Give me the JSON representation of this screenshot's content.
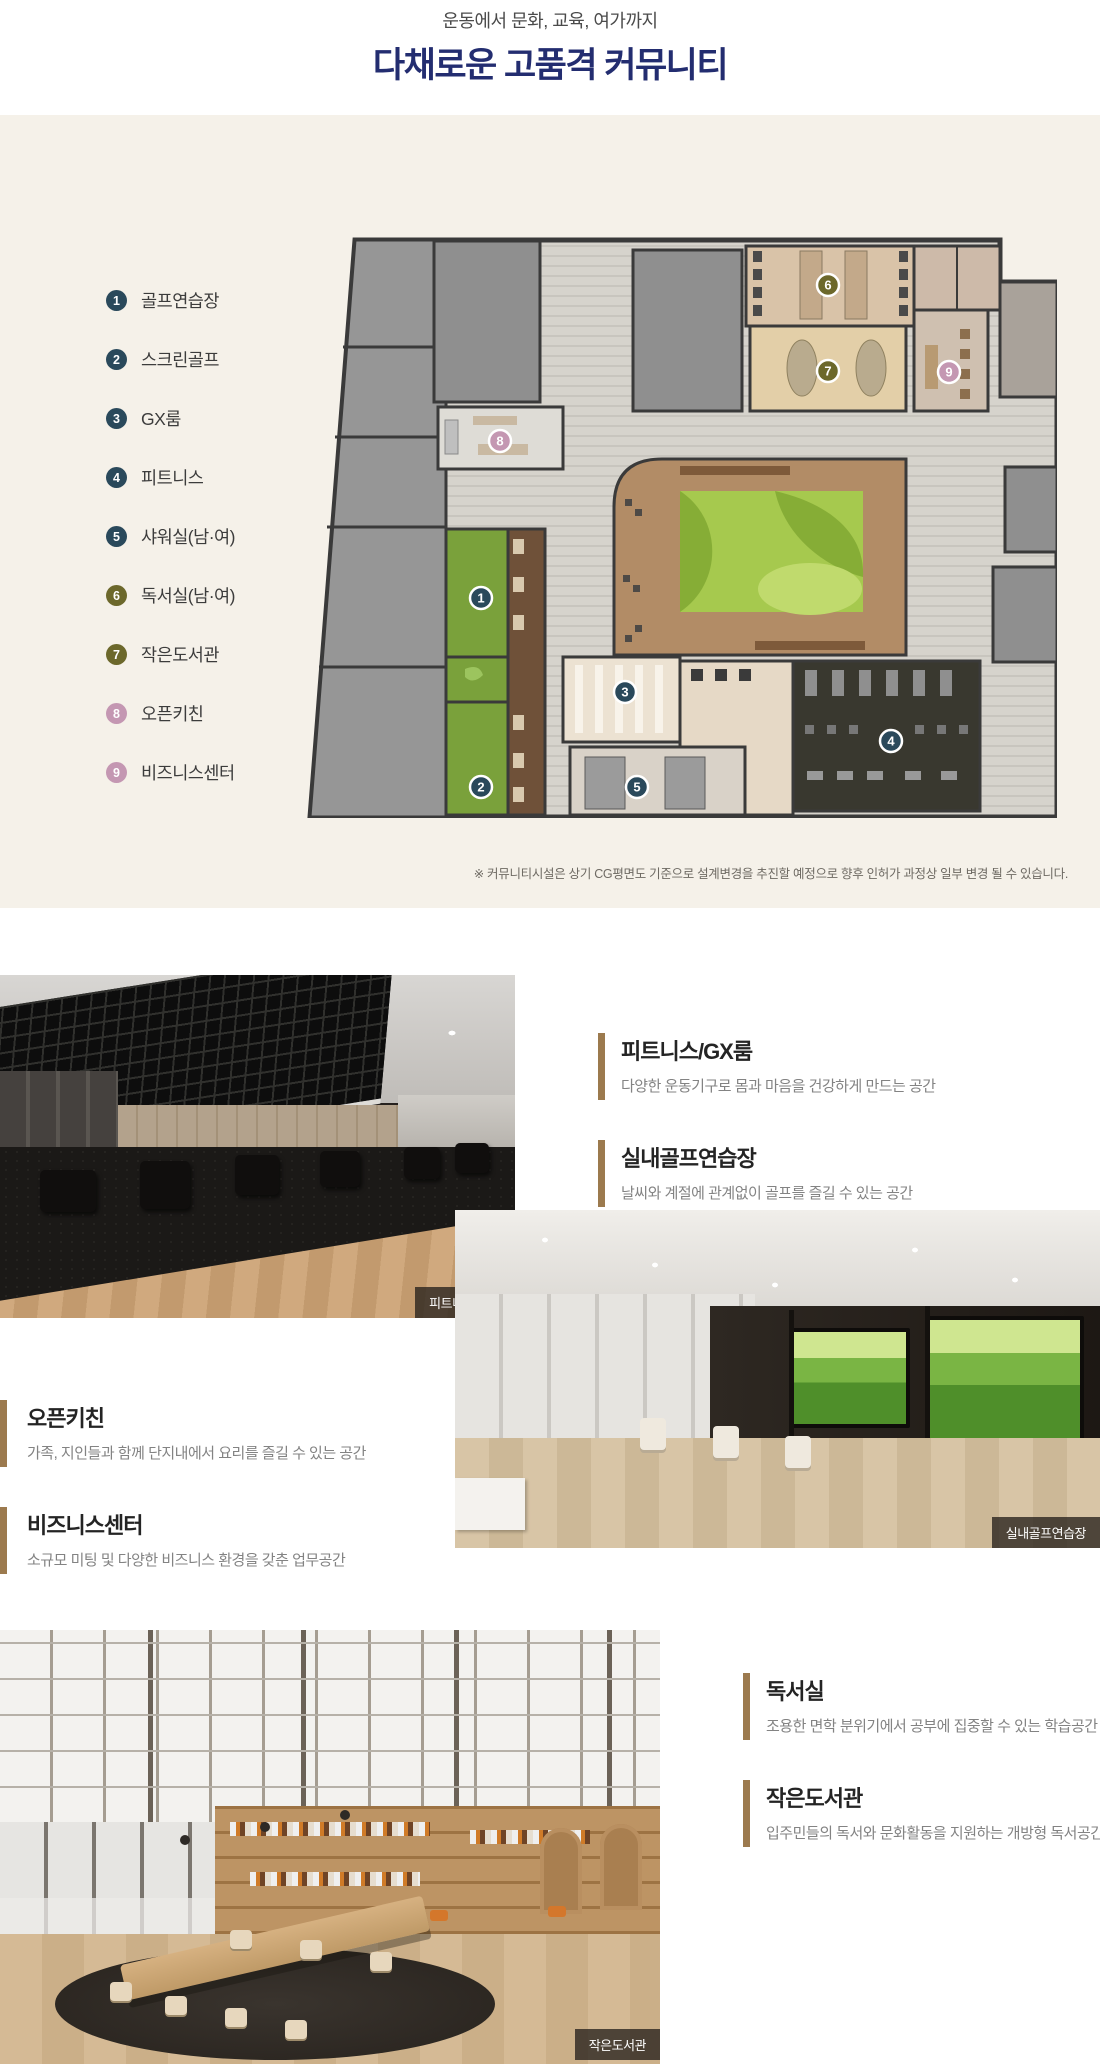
{
  "header": {
    "subtitle": "운동에서 문화, 교육, 여가까지",
    "title": "다채로운 고품격 커뮤니티"
  },
  "plan": {
    "legend": [
      {
        "num": "1",
        "label": "골프연습장",
        "color": "#2a495b"
      },
      {
        "num": "2",
        "label": "스크린골프",
        "color": "#2a495b"
      },
      {
        "num": "3",
        "label": "GX룸",
        "color": "#2a495b"
      },
      {
        "num": "4",
        "label": "피트니스",
        "color": "#2a495b"
      },
      {
        "num": "5",
        "label": "샤워실(남·여)",
        "color": "#2a495b"
      },
      {
        "num": "6",
        "label": "독서실(남·여)",
        "color": "#6c682b"
      },
      {
        "num": "7",
        "label": "작은도서관",
        "color": "#6c682b"
      },
      {
        "num": "8",
        "label": "오픈키친",
        "color": "#c497b2"
      },
      {
        "num": "9",
        "label": "비즈니스센터",
        "color": "#c497b2"
      }
    ],
    "markers": [
      {
        "num": "1",
        "color": "#2a495b"
      },
      {
        "num": "2",
        "color": "#2a495b"
      },
      {
        "num": "3",
        "color": "#2a495b"
      },
      {
        "num": "4",
        "color": "#2a495b"
      },
      {
        "num": "5",
        "color": "#2a495b"
      },
      {
        "num": "6",
        "color": "#6c682b"
      },
      {
        "num": "7",
        "color": "#6c682b"
      },
      {
        "num": "8",
        "color": "#c497b2"
      },
      {
        "num": "9",
        "color": "#c497b2"
      }
    ],
    "disclaimer": "※ 커뮤니티시설은 상기 CG평면도 기준으로 설계변경을 추진할 예정으로 향후 인허가 과정상 일부 변경 될 수 있습니다."
  },
  "features": [
    {
      "title": "피트니스/GX룸",
      "desc": "다양한 운동기구로 몸과 마음을 건강하게 만드는 공간"
    },
    {
      "title": "실내골프연습장",
      "desc": "날씨와 계절에 관계없이 골프를 즐길 수 있는 공간"
    },
    {
      "title": "오픈키친",
      "desc": "가족, 지인들과 함께 단지내에서 요리를 즐길 수 있는 공간"
    },
    {
      "title": "비즈니스센터",
      "desc": "소규모 미팅 및 다양한 비즈니스 환경을 갖춘 업무공간"
    },
    {
      "title": "독서실",
      "desc": "조용한 면학 분위기에서 공부에 집중할 수 있는 학습공간"
    },
    {
      "title": "작은도서관",
      "desc": "입주민들의 독서와 문화활동을 지원하는 개방형 독서공간"
    }
  ],
  "photos": {
    "fitness": {
      "caption": "피트니스 센터"
    },
    "golf": {
      "caption": "실내골프연습장"
    },
    "library": {
      "caption": "작은도서관"
    }
  }
}
